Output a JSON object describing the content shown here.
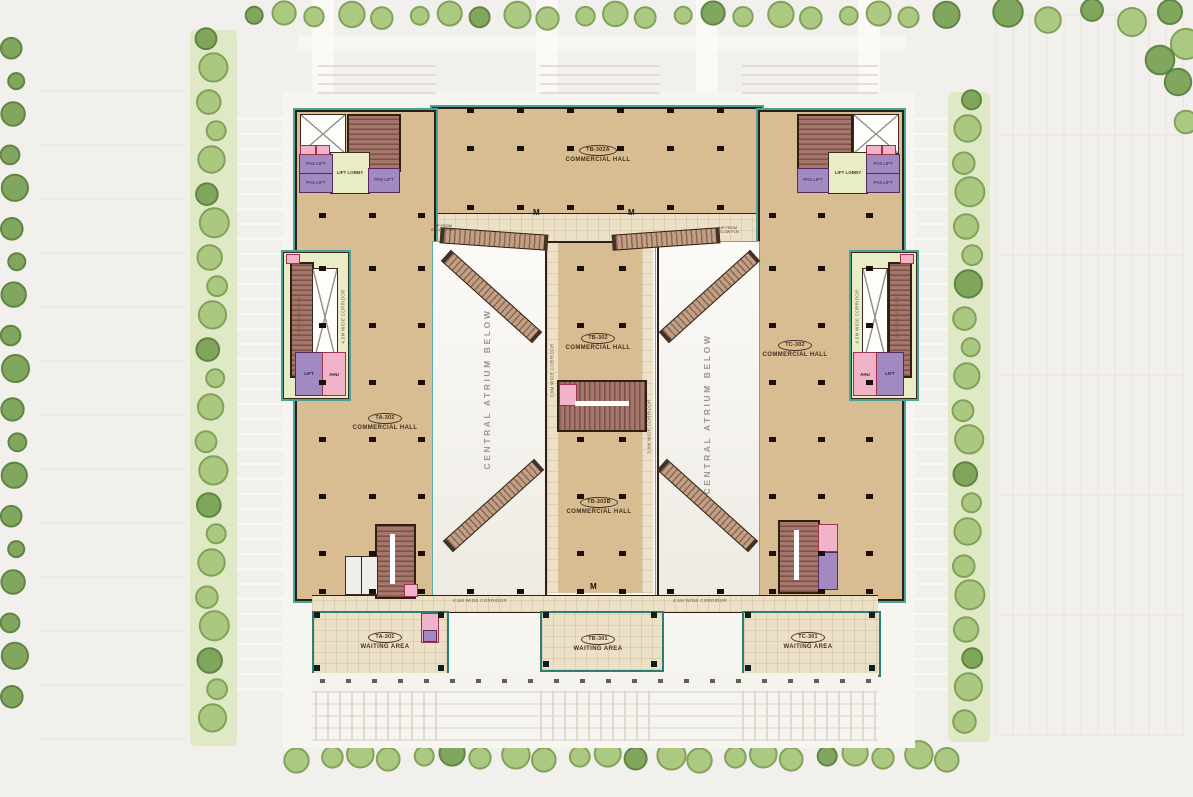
{
  "plan": {
    "halls": {
      "top": {
        "code": "TB-302A",
        "label": "COMMERCIAL HALL"
      },
      "left": {
        "code": "TA-302",
        "label": "COMMERCIAL HALL"
      },
      "center": {
        "code": "TB-302",
        "label": "COMMERCIAL HALL"
      },
      "right": {
        "code": "TC-302",
        "label": "COMMERCIAL HALL"
      },
      "center_south": {
        "code": "TB-302B",
        "label": "COMMERCIAL HALL"
      }
    },
    "waiting_areas": {
      "left": {
        "code": "TA-301",
        "label": "WAITING AREA"
      },
      "center": {
        "code": "TB-301",
        "label": "WAITING AREA"
      },
      "right": {
        "code": "TC-301",
        "label": "WAITING AREA"
      }
    },
    "atrium": {
      "label": "CENTRAL ATRIUM BELOW"
    },
    "corridors": {
      "bottom_left": "4.5M WIDE CORRIDOR",
      "bottom_right": "4.5M WIDE CORRIDOR",
      "spine_left": "3.0M WIDE CORRIDOR",
      "spine_right": "3.0M WIDE CORRIDOR",
      "left_edge": "4.5M WIDE CORRIDOR",
      "right_edge": "4.5M WIDE CORRIDOR"
    },
    "rooms": {
      "lift_lobby": "LIFT LOBBY",
      "fire_staircase": "FIRE STAIRCASE",
      "lift": "LIFT",
      "ahu": "AHU",
      "pas_lift": "PAS LIFT",
      "up_note": "UP FROM BELOW FLR.",
      "escalator_mark": "M"
    },
    "colors": {
      "hall_fill": "#d8bd92",
      "wall": "#2e2017",
      "outline_teal": "#4aa396",
      "corridor_fill": "#ece1c6",
      "lobby_fill": "#e9edc6",
      "lift_purple": "#a18ac1",
      "room_pink": "#f0b3c8",
      "stair_brown": "#a5766b",
      "atrium_white": "#fbfaf7",
      "tree_green": "#a9c77d",
      "site_bg": "#f2f0ec"
    }
  }
}
